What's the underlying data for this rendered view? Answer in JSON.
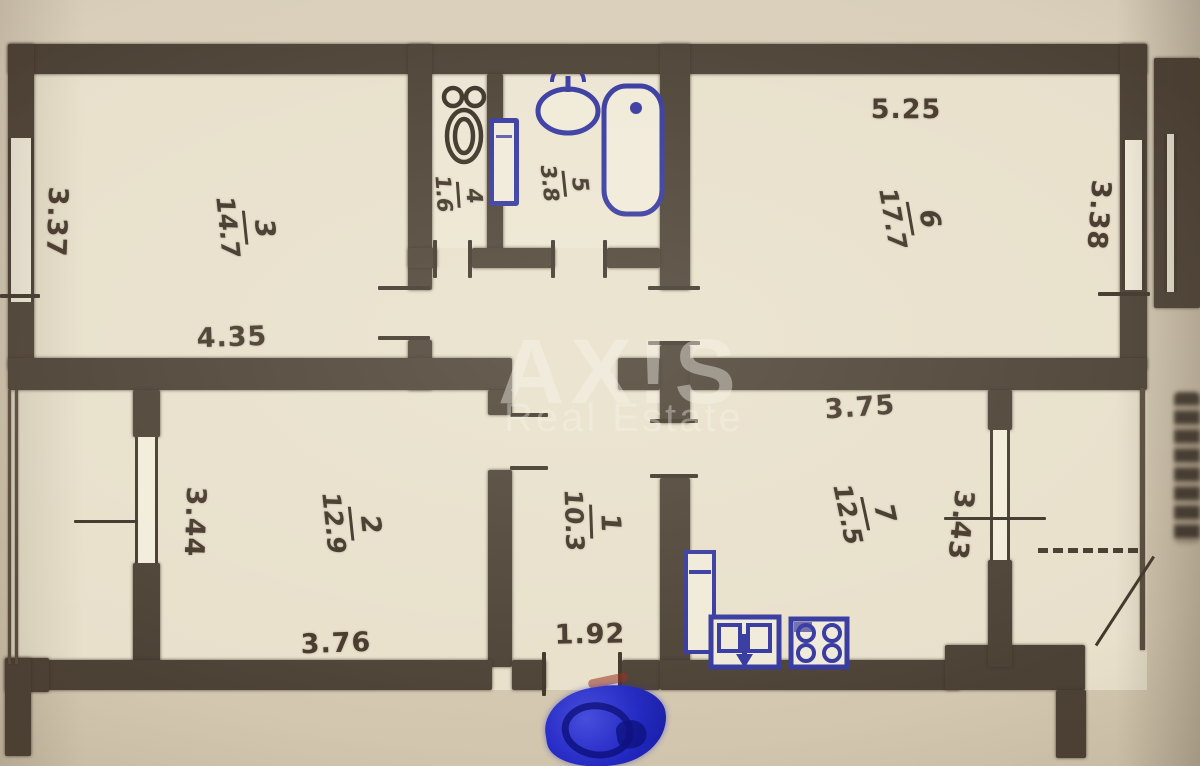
{
  "watermark": {
    "line1": "AX!S",
    "line2": "Real Estate"
  },
  "rooms": [
    {
      "name": "room-3",
      "number": "3",
      "area": "14.7"
    },
    {
      "name": "wc-4",
      "number": "4",
      "area": "1.6"
    },
    {
      "name": "bathroom-5",
      "number": "5",
      "area": "3.8"
    },
    {
      "name": "room-6",
      "number": "6",
      "area": "17.7"
    },
    {
      "name": "room-2",
      "number": "2",
      "area": "12.9"
    },
    {
      "name": "hallway-1",
      "number": "1",
      "area": "10.3"
    },
    {
      "name": "kitchen-7",
      "number": "7",
      "area": "12.5"
    }
  ],
  "dims": {
    "room3_left": "3.37",
    "room3_bottom": "4.35",
    "room6_top": "5.25",
    "room6_right": "3.38",
    "room2_left": "3.44",
    "room2_bottom": "3.76",
    "hall_bottom": "1.92",
    "kitchen_top": "3.75",
    "kitchen_right": "3.43"
  },
  "fixtures": [
    "toilet-icon",
    "washbasin-icon",
    "bathtub-icon",
    "water-heater-icon",
    "fridge-icon",
    "kitchen-sink-icon",
    "stove-icon",
    "entrance-stamp"
  ],
  "colors": {
    "wall": "#4c4135",
    "floor": "#e8e0cb",
    "paper": "#d6cbb4",
    "ink": "#44362a",
    "fixture_blue": "#34379f",
    "stamp_blue": "#2228c2"
  }
}
